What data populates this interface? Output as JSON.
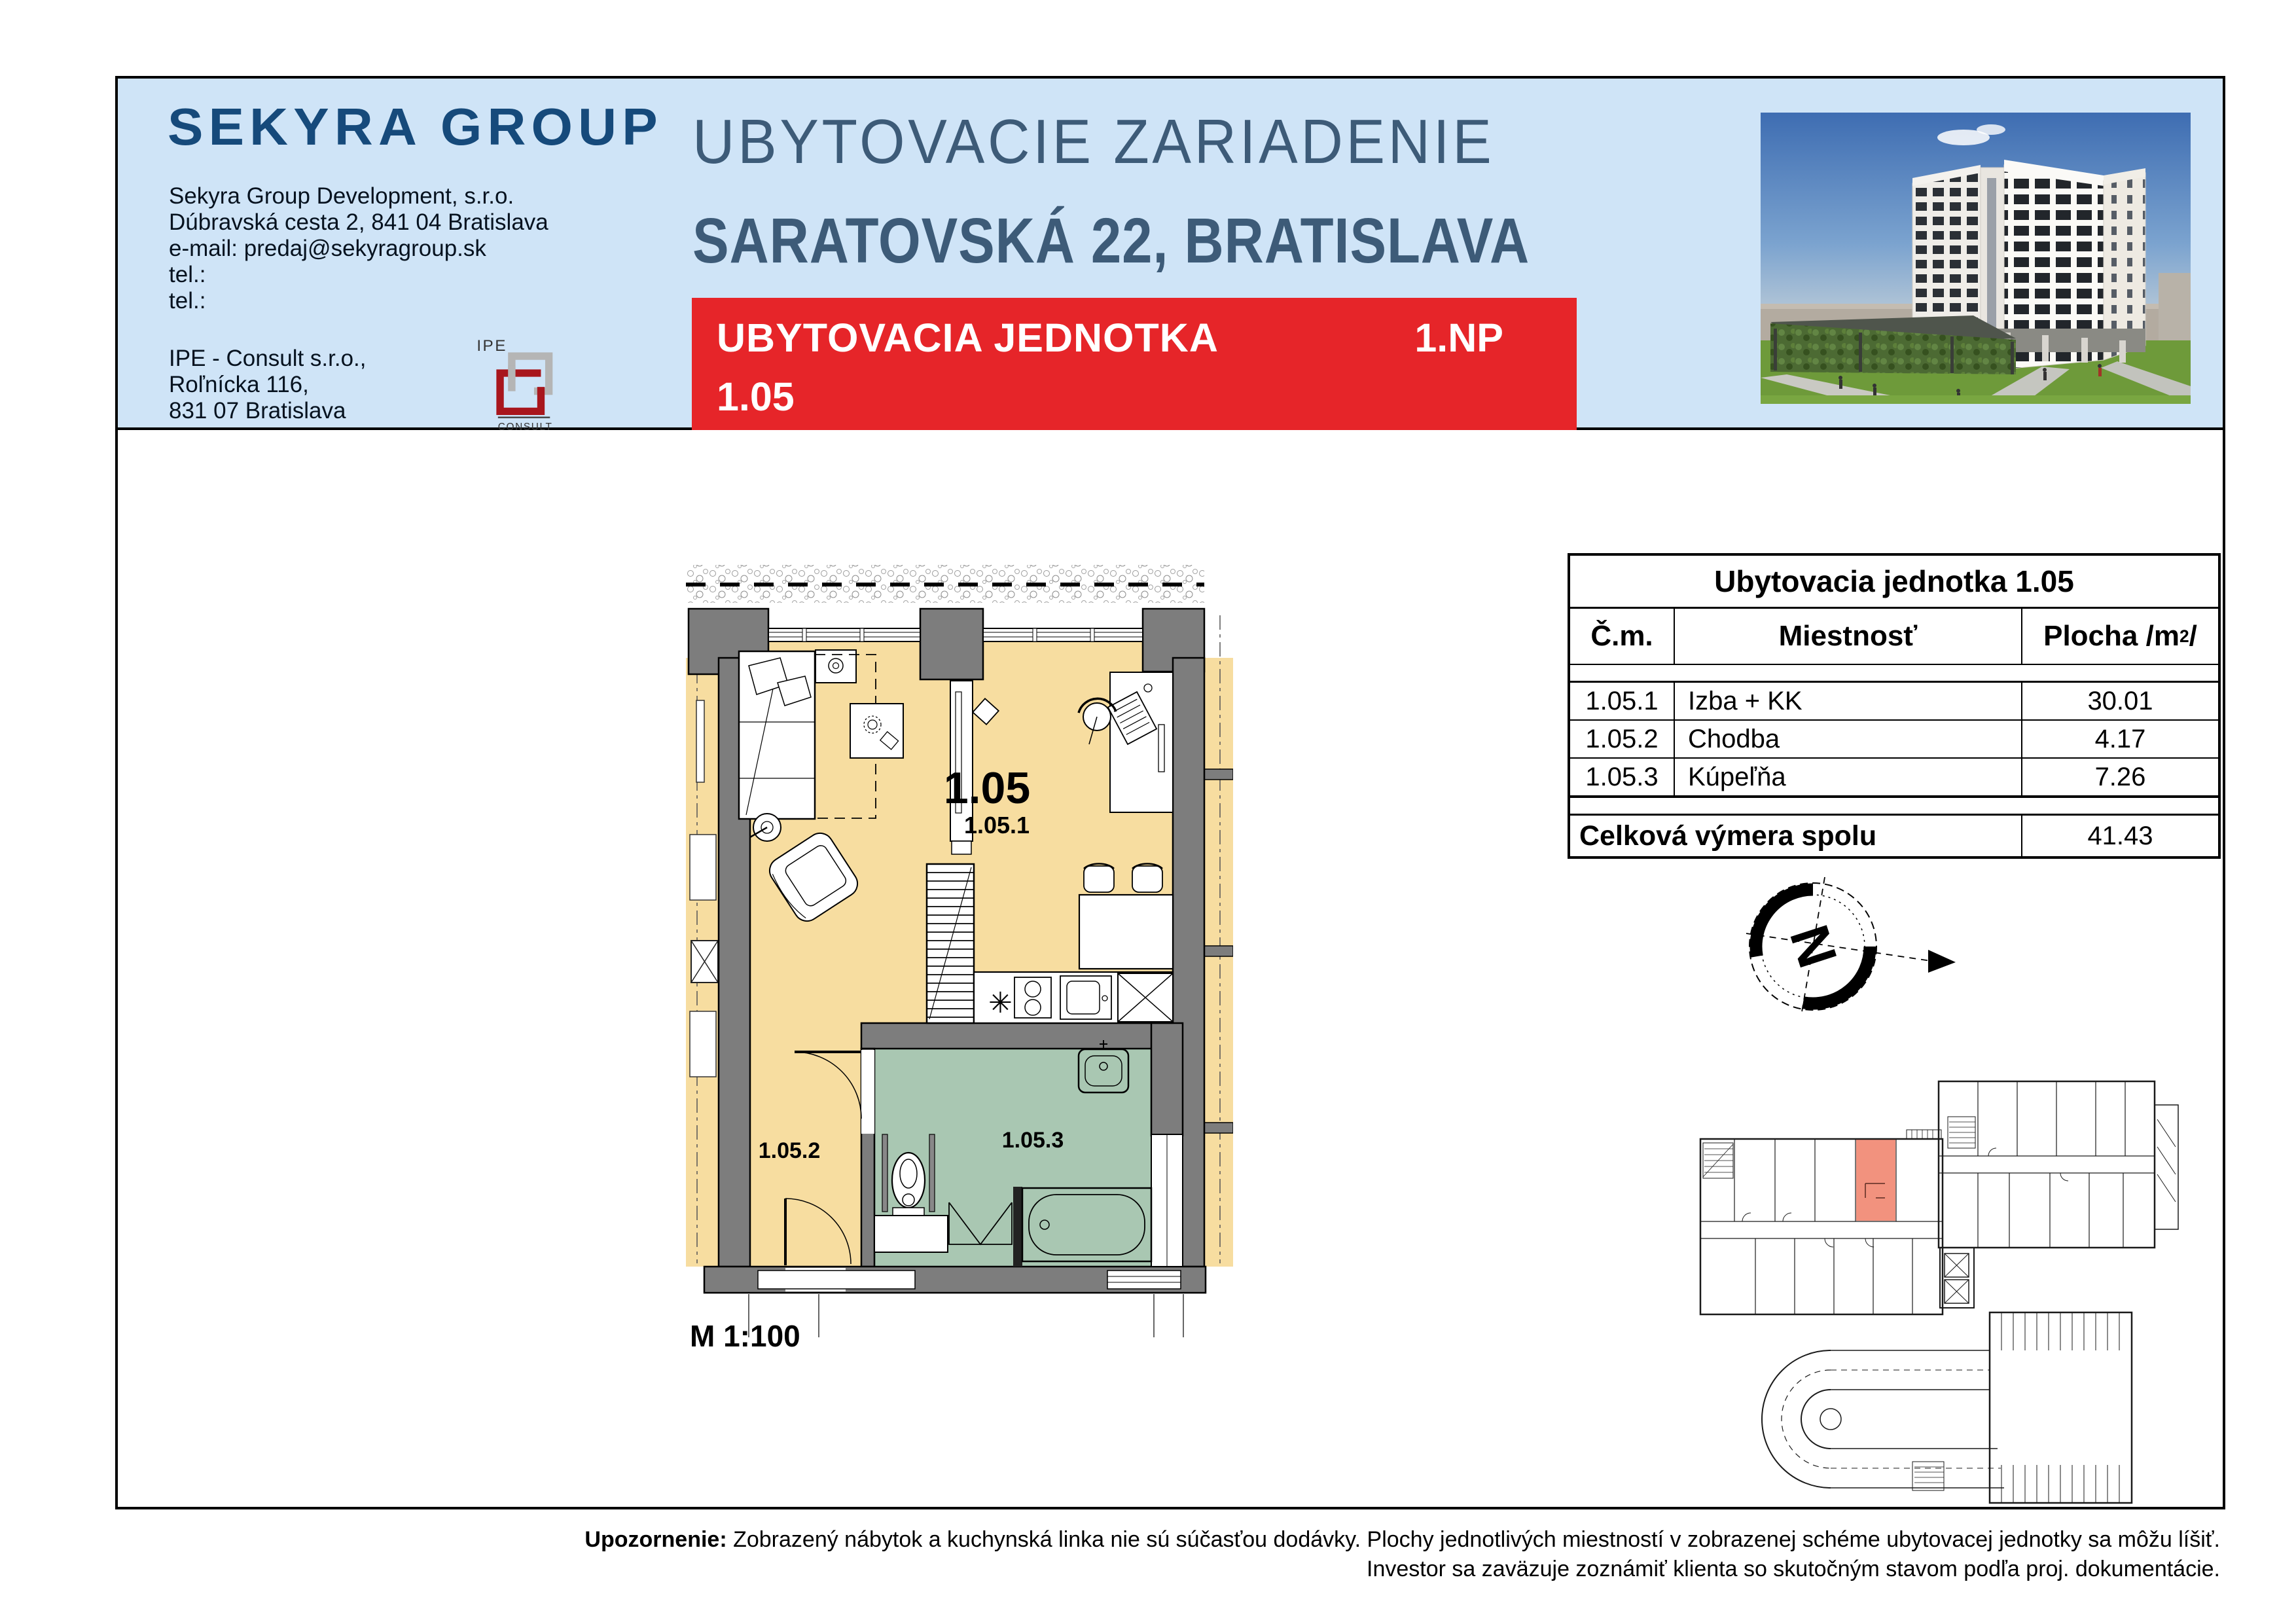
{
  "header": {
    "logo": "SEKYRA GROUP",
    "company": [
      "Sekyra Group Development, s.r.o.",
      "Dúbravská cesta 2, 841 04 Bratislava",
      "e-mail: predaj@sekyragroup.sk",
      "tel.:",
      "tel.:"
    ],
    "consultant": [
      "IPE - Consult s.r.o.,",
      "Roľnícka 116,",
      "831 07 Bratislava"
    ],
    "ipe_logo": {
      "top": "IPE",
      "bottom": "CONSULT"
    },
    "project_title": "UBYTOVACIE ZARIADENIE",
    "project_subtitle": "SARATOVSKÁ 22, BRATISLAVA",
    "banner": {
      "label": "UBYTOVACIA JEDNOTKA",
      "floor": "1.NP",
      "unit": "1.05"
    }
  },
  "plan": {
    "unit_label": "1.05",
    "room1_label": "1.05.1",
    "room2_label": "1.05.2",
    "room3_label": "1.05.3",
    "scale_note": "M 1:100"
  },
  "table": {
    "title": "Ubytovacia jednotka 1.05",
    "col_no": "Č.m.",
    "col_room": "Miestnosť",
    "col_area_prefix": "Plocha /m",
    "col_area_sup": "2",
    "col_area_suffix": "/",
    "rows": [
      {
        "no": "1.05.1",
        "room": "Izba + KK",
        "area": "30.01"
      },
      {
        "no": "1.05.2",
        "room": "Chodba",
        "area": "4.17"
      },
      {
        "no": "1.05.3",
        "room": "Kúpeľňa",
        "area": "7.26"
      }
    ],
    "total_label": "Celková výmera spolu",
    "total_value": "41.43"
  },
  "compass": {
    "letter": "N"
  },
  "footer": {
    "warn_label": "Upozornenie:",
    "line1": " Zobrazený nábytok a kuchynská linka nie sú súčasťou dodávky. Plochy jednotlivých miestností v zobrazenej schéme ubytovacej jednotky sa môžu líšiť.",
    "line2": "Investor sa zaväzuje zoznámiť klienta so skutočným stavom podľa proj. dokumentácie."
  },
  "colors": {
    "header_bg": "#cfe4f7",
    "accent_red": "#e62529",
    "title_blue": "#3d5b78",
    "logo_navy": "#164a7b",
    "plan_room_yellow": "#f7dda0",
    "plan_bath_green": "#a9c7b2",
    "plan_wall_gray": "#7d7d7d",
    "overview_highlight": "#f2927e"
  }
}
